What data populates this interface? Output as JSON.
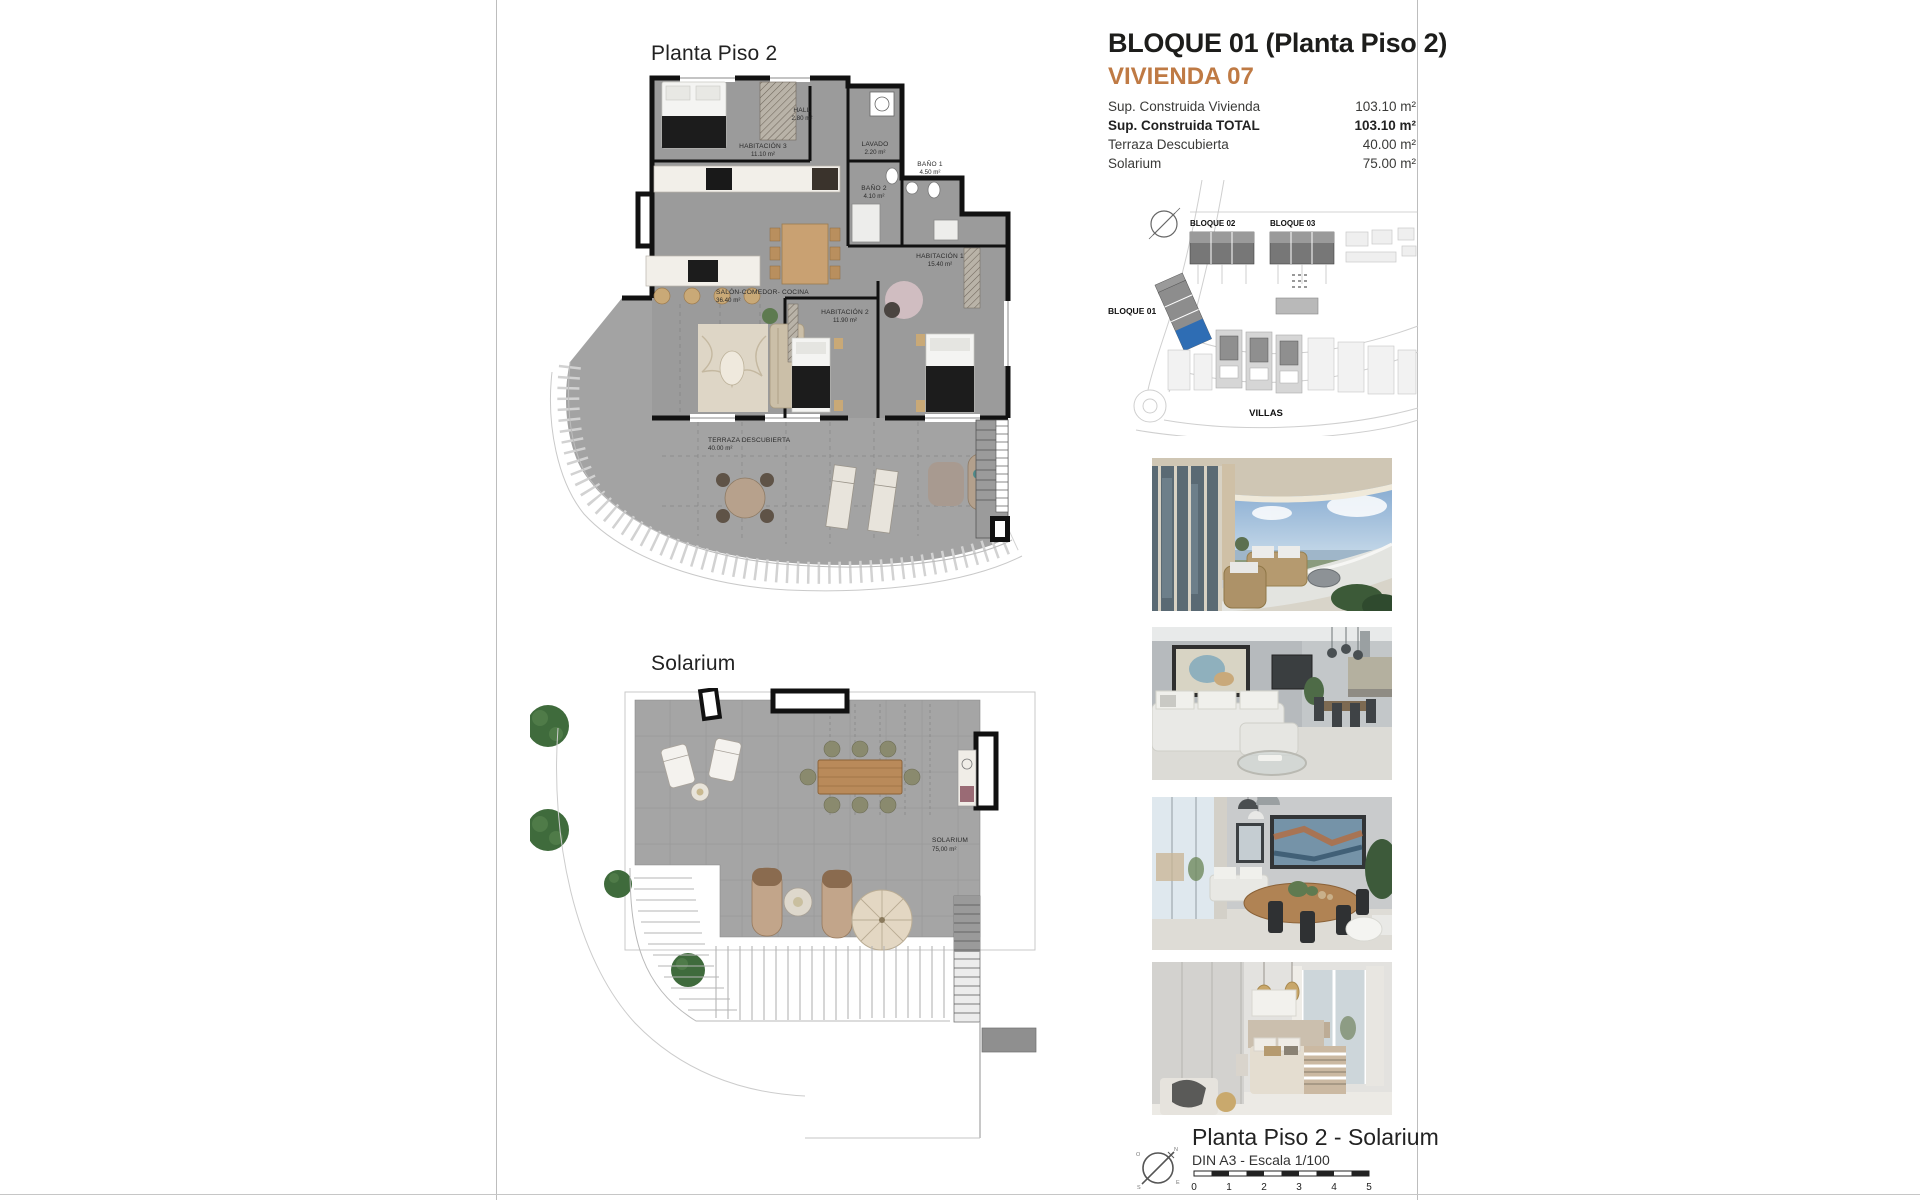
{
  "colors": {
    "accent": "#bf7a44",
    "plan_gray": "#9b9b9b",
    "terrace_gray": "#a3a3a3",
    "site_highlight_blue": "#2e6db4",
    "wall_black": "#111111"
  },
  "header": {
    "title": "BLOQUE 01  (Planta Piso 2)",
    "subtitle": "VIVIENDA 07",
    "specs": [
      {
        "label": "Sup. Construida Vivienda",
        "value": "103.10 m²"
      },
      {
        "label": "Sup. Construida TOTAL",
        "value": "103.10 m²"
      },
      {
        "label": "Terraza Descubierta",
        "value": "40.00 m²"
      },
      {
        "label": "Solarium",
        "value": "75.00 m²"
      }
    ]
  },
  "floorplan": {
    "title": "Planta Piso 2",
    "rooms": [
      {
        "name": "HALL",
        "area": "2.80 m²"
      },
      {
        "name": "HABITACIÓN 3",
        "area": "11.10 m²"
      },
      {
        "name": "LAVADO",
        "area": "2.20 m²"
      },
      {
        "name": "BAÑO 2",
        "area": "4.10 m²"
      },
      {
        "name": "BAÑO 1",
        "area": "4.50 m²"
      },
      {
        "name": "HABITACIÓN 1",
        "area": "15.40 m²"
      },
      {
        "name": "SALÓN-COMEDOR- COCINA",
        "area": "36.40 m²"
      },
      {
        "name": "HABITACIÓN 2",
        "area": "11.90 m²"
      },
      {
        "name": "TERRAZA DESCUBIERTA",
        "area": "40.00 m²"
      }
    ]
  },
  "solarium": {
    "title": "Solarium",
    "label": "SOLARIUM",
    "area": "75,00 m²"
  },
  "siteplan": {
    "bloque01": "BLOQUE 01",
    "bloque02": "BLOQUE 02",
    "bloque03": "BLOQUE 03",
    "villas": "VILLAS"
  },
  "footer": {
    "title": "Planta Piso 2 - Solarium",
    "scale_label": "DIN A3 - Escala 1/100",
    "scale_ticks": [
      "0",
      "1",
      "2",
      "3",
      "4",
      "5"
    ],
    "compass": {
      "n": "N",
      "s": "S",
      "e": "E",
      "o": "O"
    }
  }
}
